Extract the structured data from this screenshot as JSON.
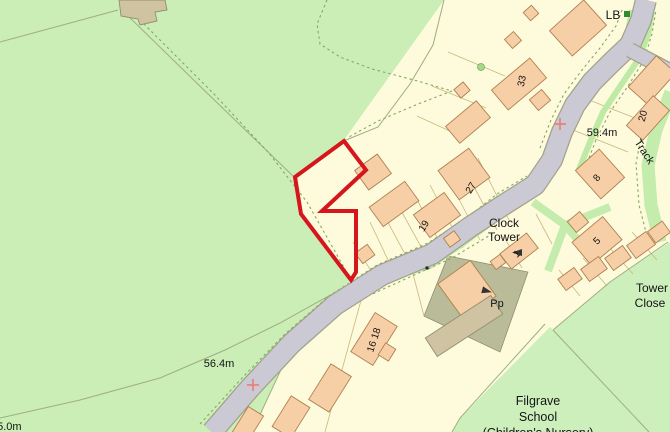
{
  "map": {
    "labels": {
      "lb": "LB",
      "track": "Track",
      "clock_tower_line1": "Clock",
      "clock_tower_line2": "Tower",
      "tower_close_line1": "Tower",
      "tower_close_line2": "Close",
      "school_line1": "Filgrave",
      "school_line2": "School",
      "school_line3": "(Children's Nursery)",
      "pp": "Pp"
    },
    "spot_heights": {
      "h1": "59.4m",
      "h2": "56.4m",
      "h3": "55.0m"
    },
    "house_numbers": {
      "n33": "33",
      "n27": "27",
      "n19": "19",
      "n20": "20",
      "n8": "8",
      "n5": "5",
      "n1": "1",
      "n16_18": "16 18"
    },
    "colors": {
      "field_green": "#cbeeb6",
      "parcel_cream": "#fdfbdc",
      "road_gray": "#cac9d4",
      "road_edge": "#a2a28c",
      "building_peach": "#f6cfa7",
      "building_khaki": "#cfc3a2",
      "parcel_khaki": "#b9bb99",
      "path_green": "#c3ecad",
      "plot_outline_red": "#d5161d",
      "marker_red": "#e97c74",
      "lb_marker_green": "#2e8b2e"
    }
  }
}
